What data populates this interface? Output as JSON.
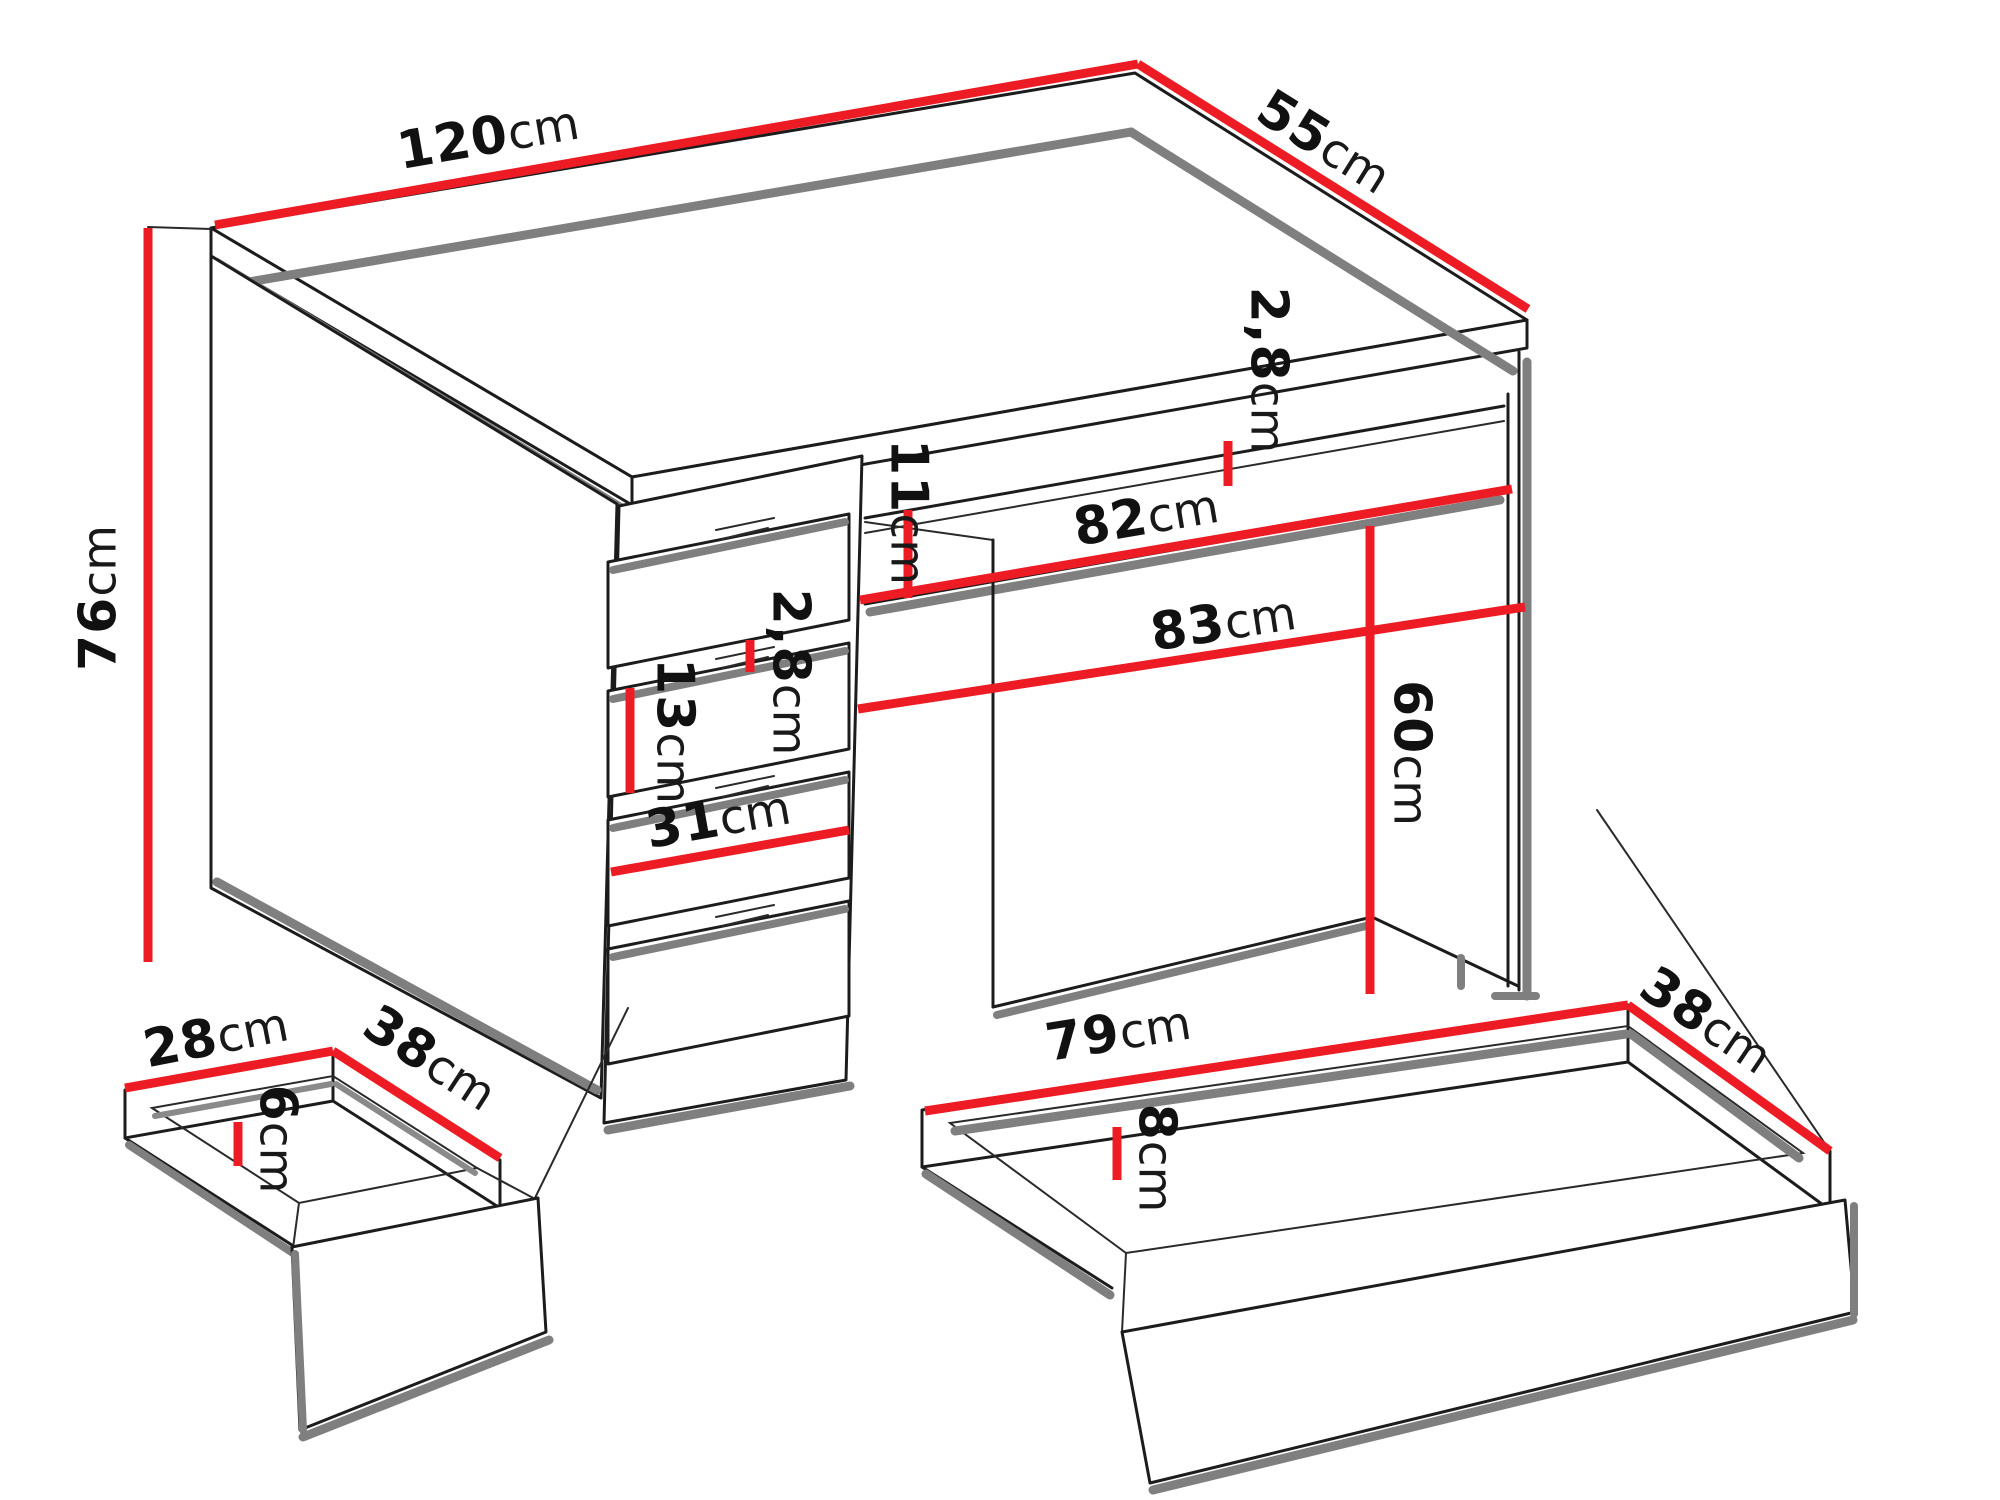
{
  "diagram": {
    "type": "furniture-dimension-drawing",
    "subject": "desk with drawer pedestal, one small pull-out drawer and one large pull-out drawer",
    "units": "cm",
    "colors": {
      "dimension_line": "#ed1c24",
      "outline": "#1c1c1c",
      "shadow_gray": "#7f7f7f",
      "background": "#ffffff",
      "label_text": "#111111"
    },
    "dims": {
      "desk_width": {
        "value": "120",
        "unit": "cm"
      },
      "desk_depth": {
        "value": "55",
        "unit": "cm"
      },
      "desk_height": {
        "value": "76",
        "unit": "cm"
      },
      "top_thickness": {
        "value": "2,8",
        "unit": "cm"
      },
      "apron_height": {
        "value": "11",
        "unit": "cm"
      },
      "front_drawer_width": {
        "value": "82",
        "unit": "cm"
      },
      "kneehole_width": {
        "value": "83",
        "unit": "cm"
      },
      "kneehole_height": {
        "value": "60",
        "unit": "cm"
      },
      "drawer_front_thickness": {
        "value": "2,8",
        "unit": "cm"
      },
      "drawer_front_height": {
        "value": "13",
        "unit": "cm"
      },
      "pedestal_width": {
        "value": "31",
        "unit": "cm"
      },
      "small_drawer_width": {
        "value": "28",
        "unit": "cm"
      },
      "small_drawer_depth": {
        "value": "38",
        "unit": "cm"
      },
      "small_drawer_height": {
        "value": "6",
        "unit": "cm"
      },
      "large_drawer_width": {
        "value": "79",
        "unit": "cm"
      },
      "large_drawer_depth": {
        "value": "38",
        "unit": "cm"
      },
      "large_drawer_height": {
        "value": "8",
        "unit": "cm"
      }
    }
  }
}
